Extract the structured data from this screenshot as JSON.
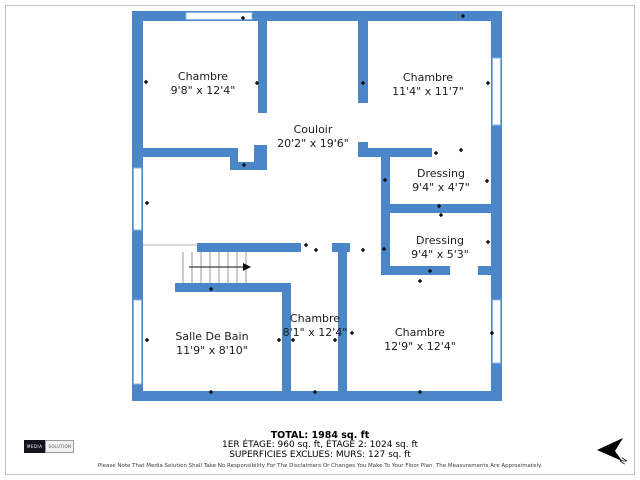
{
  "plan": {
    "wall_color": "#4a86c8",
    "rooms": [
      {
        "name": "Chambre",
        "dims": "9'8\" x 12'4\""
      },
      {
        "name": "Chambre",
        "dims": "11'4\" x 11'7\""
      },
      {
        "name": "Couloir",
        "dims": "20'2\" x 19'6\""
      },
      {
        "name": "Dressing",
        "dims": "9'4\" x 4'7\""
      },
      {
        "name": "Dressing",
        "dims": "9'4\" x 5'3\""
      },
      {
        "name": "Chambre",
        "dims": "8'1\" x 12'4\""
      },
      {
        "name": "Salle De Bain",
        "dims": "11'9\" x 8'10\""
      },
      {
        "name": "Chambre",
        "dims": "12'9\" x 12'4\""
      }
    ]
  },
  "summary": {
    "total": "TOTAL: 1984 sq. ft",
    "floors": "1ER ÉTAGE: 960 sq. ft, ÉTAGE 2: 1024 sq. ft",
    "exclusions": "SUPERFICIES EXCLUES: MURS: 127 sq. ft"
  },
  "disclaimer": "Please Note That Media Solution Shall Take No Responsibility For The Disclaimers Or Changes You Make To Your Floor Plan. The Measurements Are Approximately.",
  "logo": {
    "left": "MEDIA",
    "right": "SOLUTION"
  },
  "compass": {
    "label": "N"
  }
}
